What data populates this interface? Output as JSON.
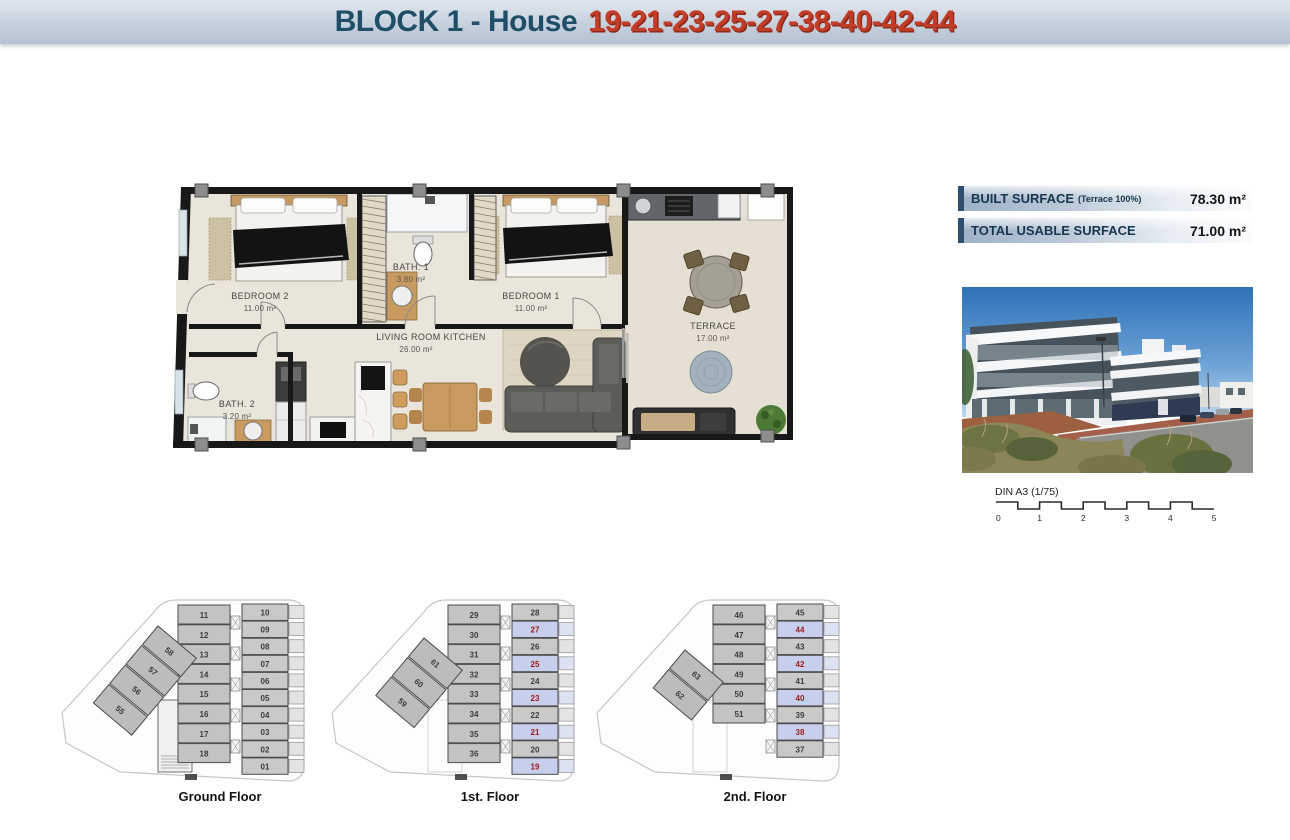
{
  "header": {
    "title": "BLOCK 1 - House",
    "numbers": "19-21-23-25-27-38-40-42-44"
  },
  "surface_table": {
    "rows": [
      {
        "label": "BUILT SURFACE",
        "note": "(Terrace 100%)",
        "value": "78.30 m²"
      },
      {
        "label": "TOTAL USABLE SURFACE",
        "note": "",
        "value": "71.00 m²"
      }
    ]
  },
  "plan": {
    "rooms": {
      "bedroom2": {
        "name": "BEDROOM 2",
        "area": "11.00 m²"
      },
      "bath1": {
        "name": "BATH. 1",
        "area": "3.80 m²"
      },
      "bedroom1": {
        "name": "BEDROOM 1",
        "area": "11.00 m²"
      },
      "living": {
        "name": "LIVING ROOM KITCHEN",
        "area": "26.00 m²"
      },
      "bath2": {
        "name": "BATH. 2",
        "area": "3.20 m²"
      },
      "terrace": {
        "name": "TERRACE",
        "area": "17.00 m²"
      }
    }
  },
  "scale_bar": {
    "label": "DIN A3 (1/75)",
    "ticks": [
      "0",
      "1",
      "2",
      "3",
      "4",
      "5"
    ]
  },
  "floors": [
    {
      "label": "Ground Floor",
      "left_units": [
        "11",
        "12",
        "13",
        "14",
        "15",
        "16",
        "17",
        "18"
      ],
      "right_units": [
        {
          "n": "10"
        },
        {
          "n": "09"
        },
        {
          "n": "08"
        },
        {
          "n": "07"
        },
        {
          "n": "06"
        },
        {
          "n": "05"
        },
        {
          "n": "04"
        },
        {
          "n": "03"
        },
        {
          "n": "02"
        },
        {
          "n": "01"
        }
      ],
      "diagonal_units": [
        "58",
        "57",
        "56",
        "55"
      ]
    },
    {
      "label": "1st. Floor",
      "left_units": [
        "29",
        "30",
        "31",
        "32",
        "33",
        "34",
        "35",
        "36"
      ],
      "right_units": [
        {
          "n": "28"
        },
        {
          "n": "27",
          "hl": true
        },
        {
          "n": "26"
        },
        {
          "n": "25",
          "hl": true
        },
        {
          "n": "24"
        },
        {
          "n": "23",
          "hl": true
        },
        {
          "n": "22"
        },
        {
          "n": "21",
          "hl": true
        },
        {
          "n": "20"
        },
        {
          "n": "19",
          "hl": true
        }
      ],
      "diagonal_units": [
        "61",
        "60",
        "59"
      ]
    },
    {
      "label": "2nd. Floor",
      "left_units": [
        "46",
        "47",
        "48",
        "49",
        "50",
        "51"
      ],
      "right_units": [
        {
          "n": "45"
        },
        {
          "n": "44",
          "hl": true
        },
        {
          "n": "43"
        },
        {
          "n": "42",
          "hl": true
        },
        {
          "n": "41"
        },
        {
          "n": "40",
          "hl": true
        },
        {
          "n": "39"
        },
        {
          "n": "38",
          "hl": true
        },
        {
          "n": "37"
        }
      ],
      "diagonal_units": [
        "63",
        "62"
      ]
    }
  ],
  "colors": {
    "header_title": "#1f4f68",
    "header_numbers": "#c23d28",
    "unit_highlight_bg": "#c7cfec",
    "unit_highlight_text": "#9e1a1a",
    "plan_floor": "#eae5da",
    "wall": "#181818"
  }
}
